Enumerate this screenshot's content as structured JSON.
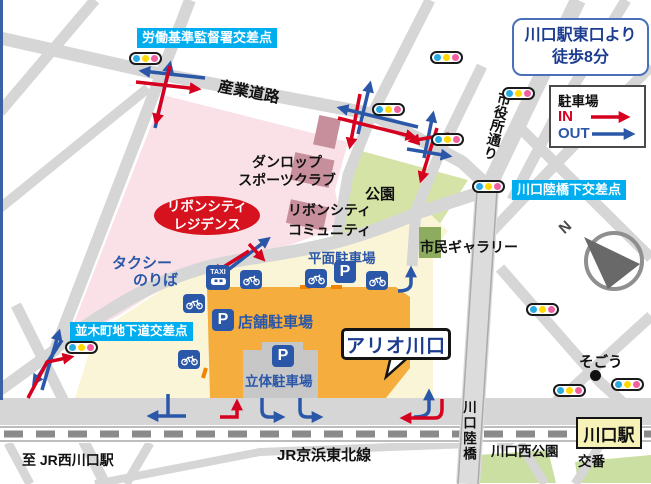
{
  "info_box": {
    "line1": "川口駅東口より",
    "line2": "徒歩8分"
  },
  "legend": {
    "title": "駐車場",
    "in_label": "IN",
    "out_label": "OUT"
  },
  "intersections": {
    "rodo": "労働基準監督署交差点",
    "namiki": "並木町地下道交差点",
    "rikkyoshita": "川口陸橋下交差点"
  },
  "roads": {
    "sangyo": "産業道路",
    "shiyakusho": "市役所通り",
    "rikkyo": "川口陸橋",
    "jr_line": "JR京浜東北線",
    "to_nishikawaguchi": "至 JR西川口駅"
  },
  "places": {
    "dunlop_l1": "ダンロップ",
    "dunlop_l2": "スポーツクラブ",
    "residence_l1": "リボンシティ",
    "residence_l2": "レジデンス",
    "community_l1": "リボンシティ",
    "community_l2": "コミュニティ",
    "park": "公園",
    "gallery": "市民ギャラリー",
    "taxi_l1": "タクシー",
    "taxi_l2": "のりば",
    "surface_parking": "平面駐車場",
    "store_parking": "店舗駐車場",
    "multistory_parking": "立体駐車場",
    "main_building": "アリオ川口",
    "sogo": "そごう",
    "west_park": "川口西公園",
    "station": "川口駅",
    "koban": "交番"
  },
  "icons": {
    "parking": "P",
    "taxi": "TAXI",
    "compass_north": "N",
    "traffic_light": "traffic-light (blue/yellow/pink dots)",
    "bicycle": "bicycle-parking"
  },
  "colors": {
    "in_red": "#D6001F",
    "out_blue": "#2B57A8",
    "label_cyan": "#00AEEF",
    "navy_text": "#1C3C90",
    "building_orange": "#F5AE3D",
    "residential_pink": "#F9E1E7",
    "park_green": "#D5E3A6",
    "signal_dots": [
      "#29ABE2",
      "#FFD900",
      "#F0609E"
    ]
  }
}
